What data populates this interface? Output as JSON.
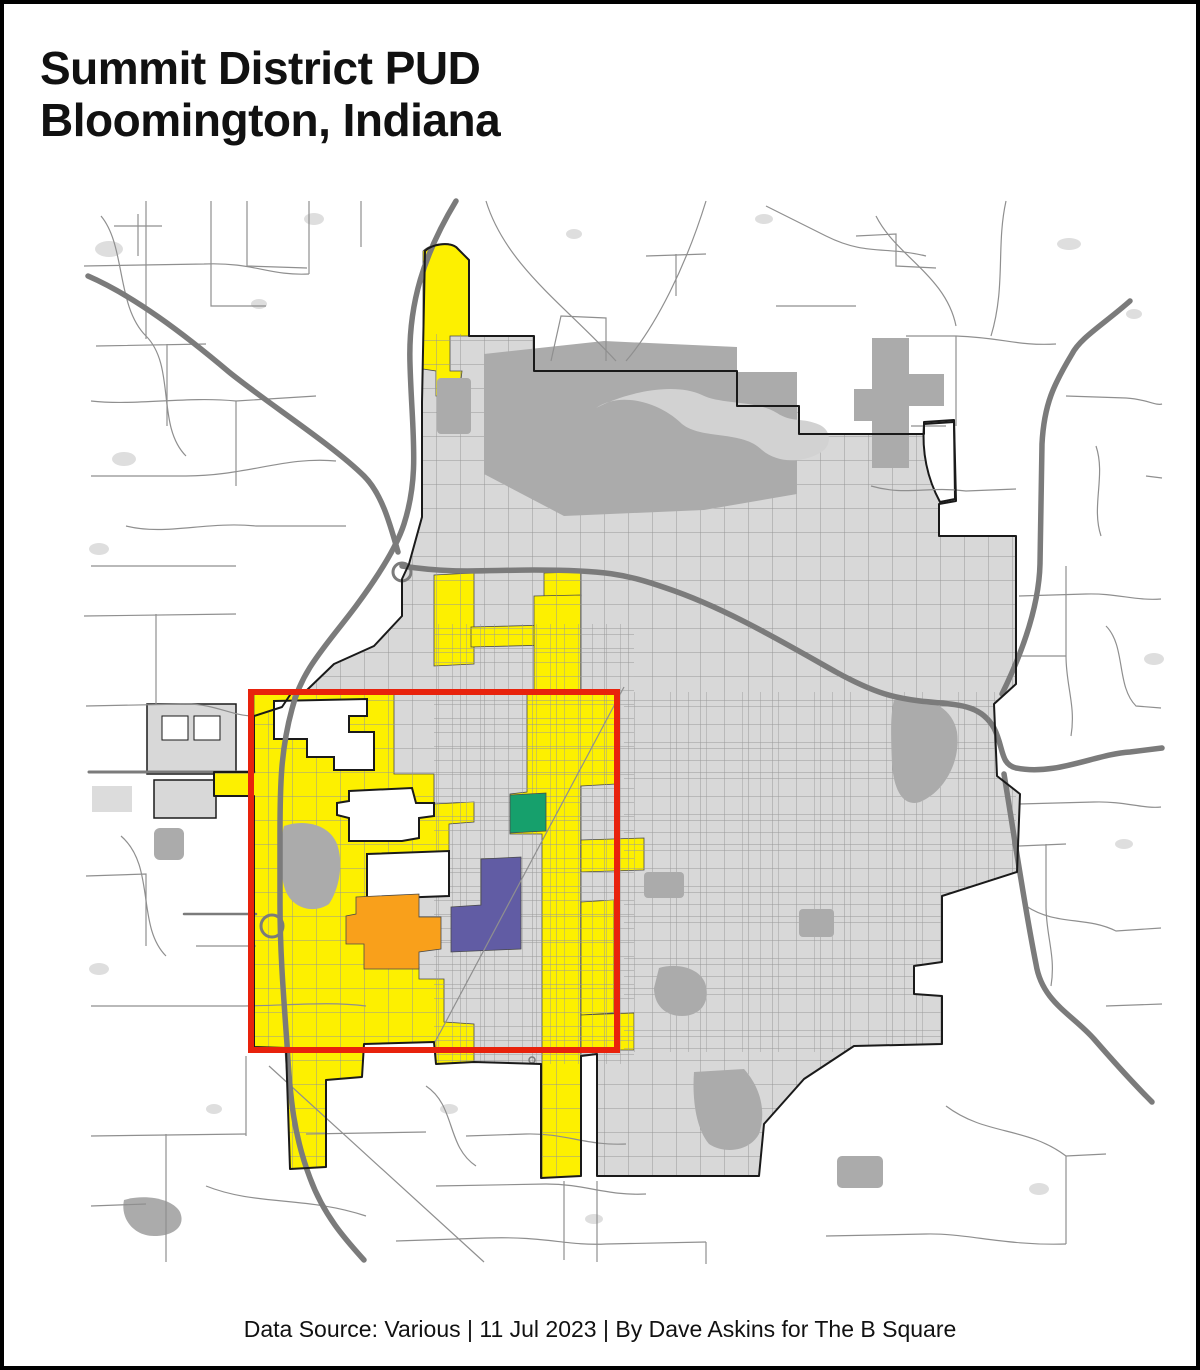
{
  "header": {
    "title_line1": "Summit District PUD",
    "title_line2": "Bloomington, Indiana"
  },
  "footer": {
    "text": "Data Source: Various | 11 Jul 2023 | By Dave Askins for The B Square"
  },
  "map": {
    "highlight_box": {
      "x": 247,
      "y": 688,
      "width": 366,
      "height": 358,
      "color": "#E8220C"
    },
    "colors": {
      "pud_yellow": "#FDF000",
      "pud_orange": "#F9A01B",
      "pud_purple": "#615CA4",
      "pud_green": "#16A06C",
      "city_fill": "#D8D8D8",
      "park_fill": "#ABABAB",
      "lake_fill": "#D2D2D2",
      "highway": "#7B7B7B",
      "road": "#8F8F8F",
      "boundary": "#1A1A1A"
    }
  }
}
